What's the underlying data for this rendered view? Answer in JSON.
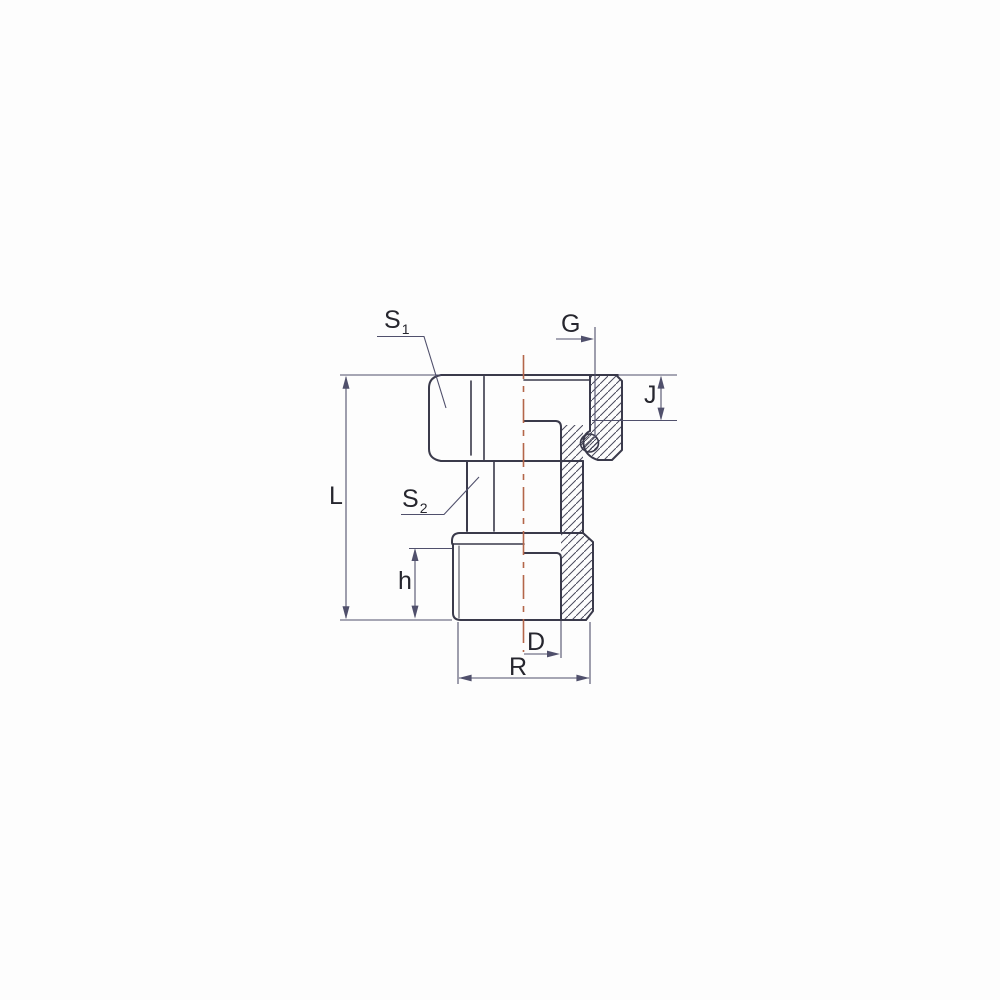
{
  "drawing": {
    "labels": {
      "s1": {
        "main": "S",
        "sub": "1"
      },
      "s2": {
        "main": "S",
        "sub": "2"
      },
      "g": "G",
      "j": "J",
      "l": "L",
      "h": "h",
      "d": "D",
      "r": "R"
    },
    "colors": {
      "outline": "#3a3a4b",
      "dimension": "#50506c",
      "centerline": "#b4664a",
      "hatch": "#4a4a5c",
      "text": "#26262e",
      "background": "#fdfdfd"
    }
  }
}
